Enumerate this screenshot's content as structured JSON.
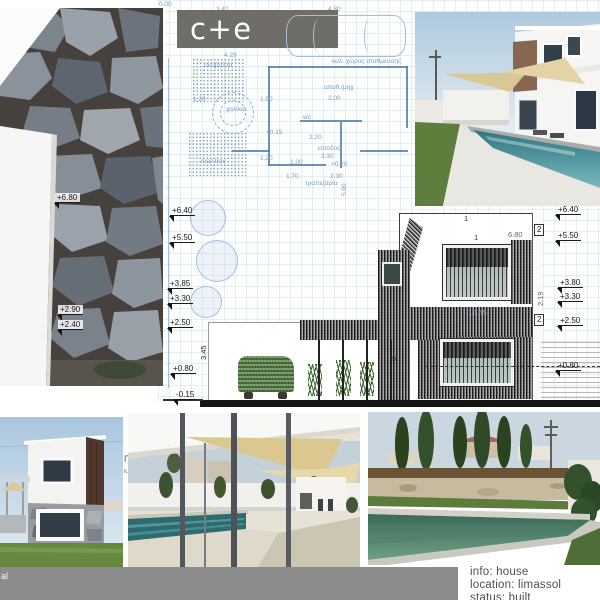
{
  "logo": {
    "text": "c+e",
    "bg": "#6f6d67"
  },
  "plan": {
    "texts": [
      "0.00",
      "3.42",
      "4.80",
      "4.29",
      "σκύβαλλα",
      "καλ. χώρος σταθμευσης",
      "αποθ./μηχ",
      "1.20",
      "1.90",
      "2.00",
      "wc",
      "2.20",
      "είσοδος",
      "3.30",
      "1.20",
      "1.00",
      "+0.20",
      "1.70",
      "2.30",
      "τραπεζαρία",
      "5.90",
      "mail box",
      "χαλίκια",
      "+0.15",
      "ΠΡ",
      "ΚΑΙ"
    ]
  },
  "section": {
    "texts": [
      "1",
      "1",
      "2",
      "6.80",
      "2",
      "10.45",
      "2.19",
      "5",
      "3.45"
    ]
  },
  "levels": {
    "left": [
      "+6.40",
      "+5.50",
      "+3.85",
      "+3.30",
      "+2.50",
      "+0.80",
      "-0.15"
    ],
    "right": [
      "+6.40",
      "+5.50",
      "+3.80",
      "+3.30",
      "+2.50",
      "+0.80"
    ],
    "photo": [
      "+6.80",
      "+2.90",
      "+2.40"
    ]
  },
  "info": {
    "line1": "info: house",
    "line2": "location: limassol",
    "line3": "status: built"
  },
  "footer": {
    "fragment": "al",
    "bar_color": "#8c8c8c"
  },
  "colors": {
    "blueprint_line": "#7d9ec2",
    "logo_bg": "#6f6d67",
    "info_text": "#4f4f4f"
  },
  "photos": {
    "top_left": "stone-wall-cladding",
    "top_right": "white-house-with-pool",
    "bottom_left": "two-storey-house-exterior",
    "bottom_middle": "pool-terrace-shade-sails",
    "bottom_right": "pool-with-cypress-trees"
  }
}
